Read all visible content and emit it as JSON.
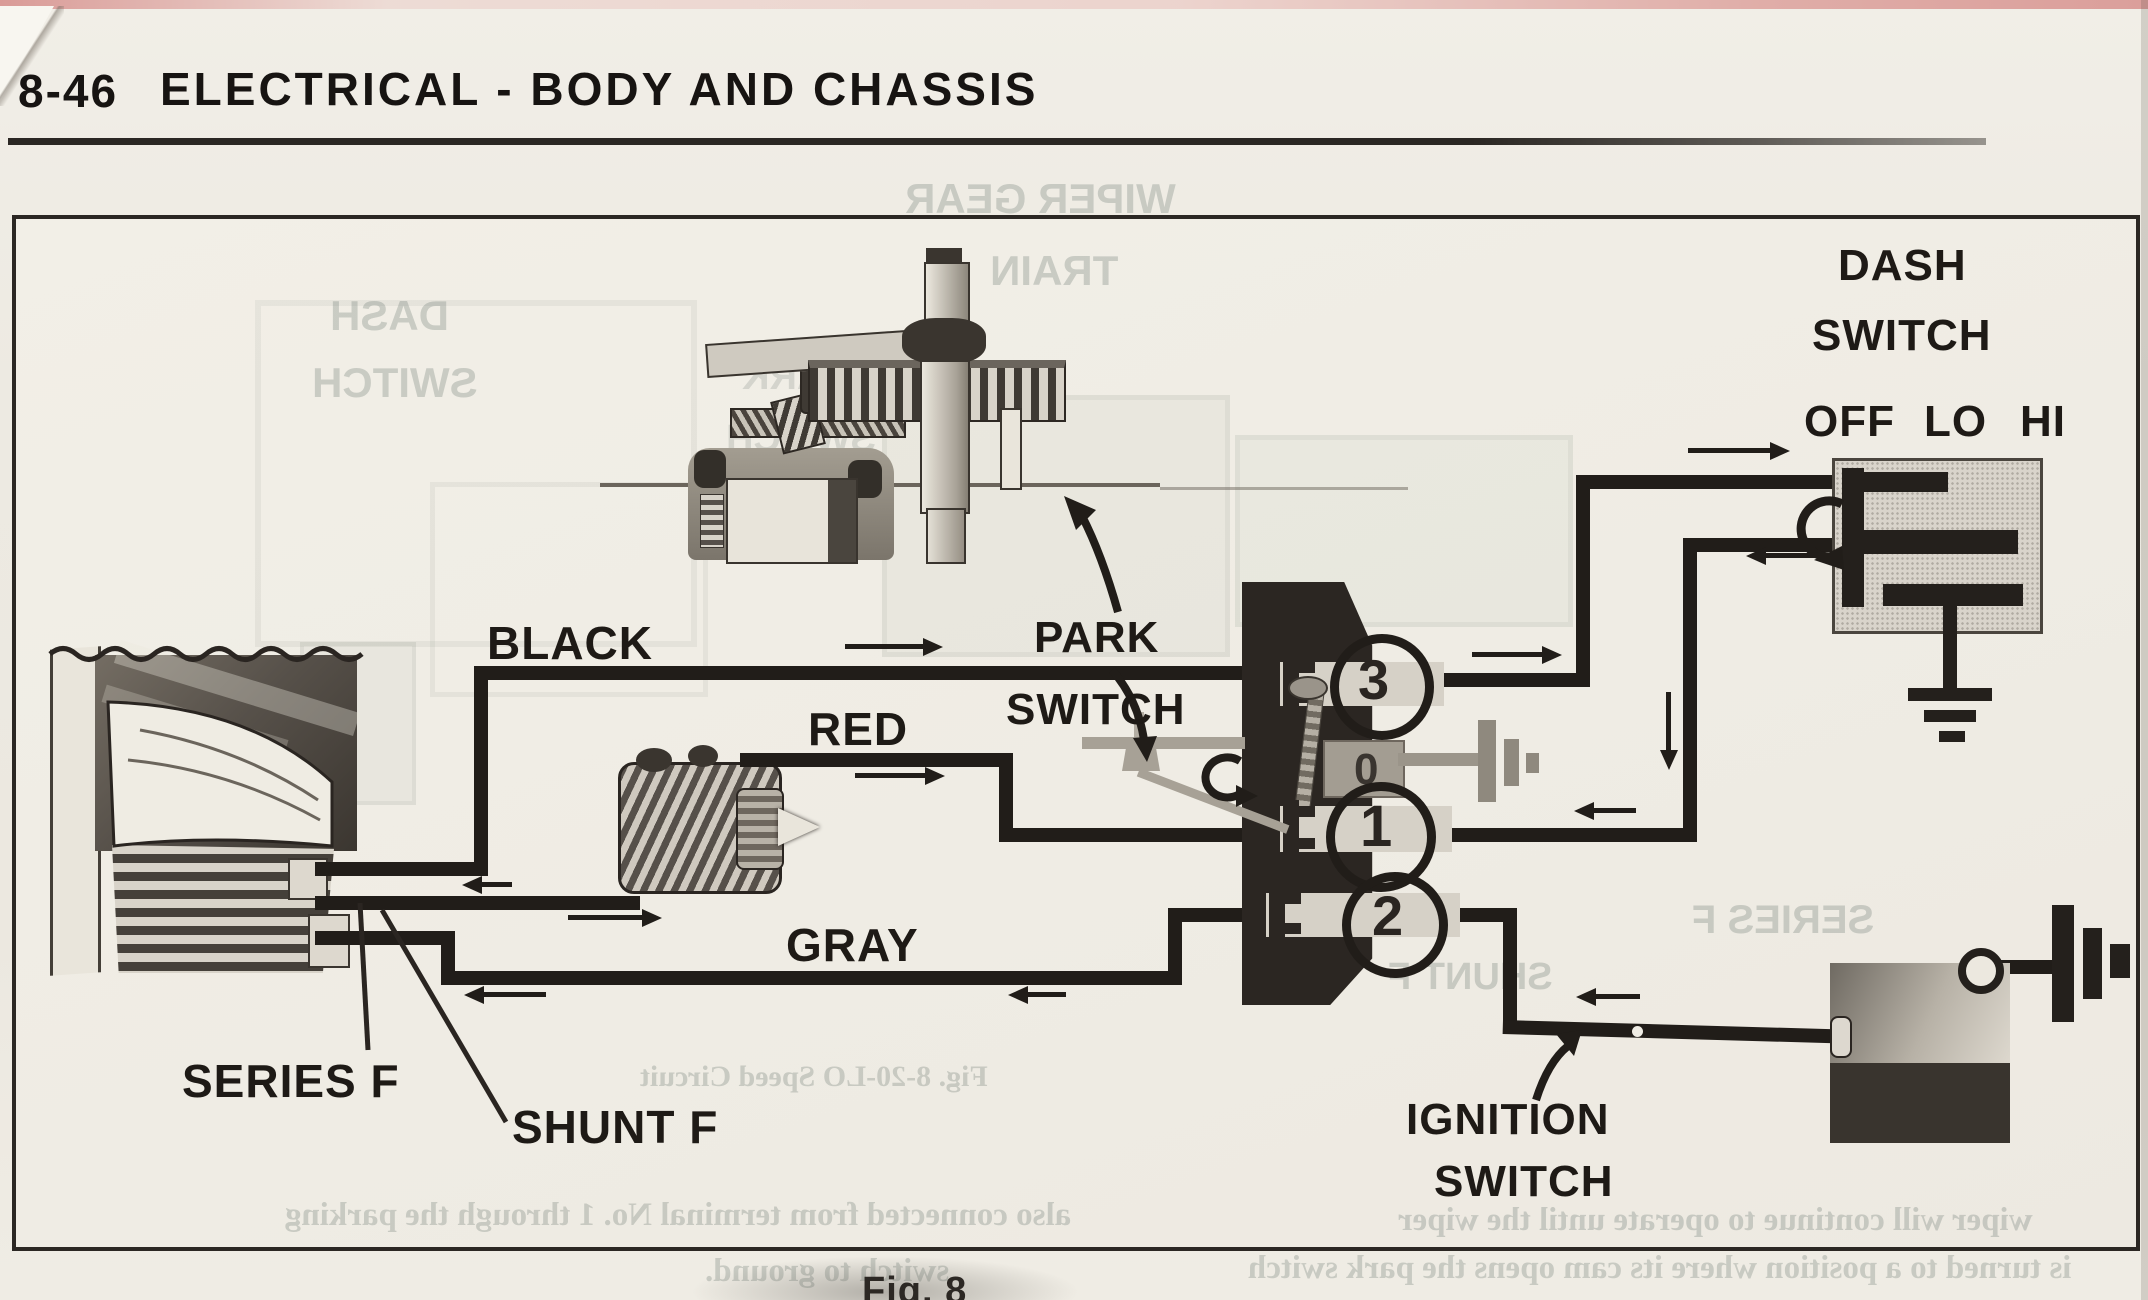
{
  "page": {
    "number": "8-46",
    "title": "ELECTRICAL - BODY AND CHASSIS",
    "figure_caption": "Fig. 8"
  },
  "diagram": {
    "wire_labels": {
      "black": "BLACK",
      "red": "RED",
      "gray": "GRAY"
    },
    "field_labels": {
      "series": "SERIES F",
      "shunt": "SHUNT F"
    },
    "park_switch": {
      "line1": "PARK",
      "line2": "SWITCH"
    },
    "dash_switch": {
      "line1": "DASH",
      "line2": "SWITCH",
      "positions": {
        "off": "OFF",
        "lo": "LO",
        "hi": "HI"
      }
    },
    "ignition_switch": {
      "line1": "IGNITION",
      "line2": "SWITCH"
    },
    "terminals": [
      "3",
      "0",
      "1",
      "2"
    ]
  },
  "bleed_through": {
    "dash_switch_line1": "DASH",
    "dash_switch_line2": "SWITCH",
    "gear_train_line1": "WIPER GEAR",
    "gear_train_line2": "TRAIN",
    "park_switch_line1": "PARK",
    "park_switch_line2": "SWITCH",
    "series_field": "SERIES F",
    "shunt_field": "SHUNT F",
    "figure_caption": "Fig. 8-20-LO Speed Circuit",
    "text_bottom_left_1": "also connected from terminal No. 1 through the parking",
    "text_bottom_left_2": "switch to ground.",
    "text_bottom_right_1": "wiper will continue to operate until the wiper",
    "text_bottom_right_2": "is turned to a position where its cam opens the park switch"
  },
  "colors": {
    "ink": "#211d19",
    "paper": "#edeae2",
    "gray_ink": "#8f897e",
    "bleed_text": "#6e7c75",
    "scan_edge_pink": "#d98f8c"
  }
}
